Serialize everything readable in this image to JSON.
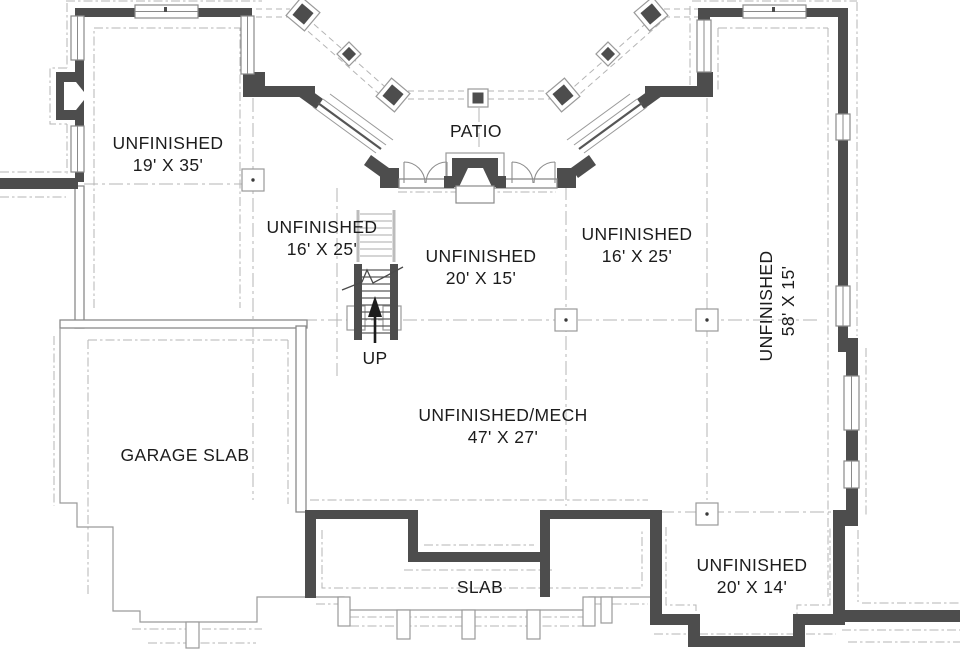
{
  "plan": {
    "title": "basement foundation floor plan",
    "colors": {
      "bg": "#ffffff",
      "wall": "#4d4d4d",
      "thin_wall": "#8a8a8a",
      "footing": "#b5b5b5",
      "text": "#1c1c1c"
    },
    "rooms": {
      "upper_left": {
        "label": "UNFINISHED",
        "dims": "19' X 35'"
      },
      "patio": {
        "label": "PATIO"
      },
      "mid_left": {
        "label": "UNFINISHED",
        "dims": "16' X 25'"
      },
      "center": {
        "label": "UNFINISHED",
        "dims": "20' X 15'"
      },
      "mid_right": {
        "label": "UNFINISHED",
        "dims": "16' X 25'"
      },
      "right_wing": {
        "label": "UNFINISHED",
        "dims": "58' X 15'"
      },
      "garage": {
        "label": "GARAGE SLAB"
      },
      "mech": {
        "label": "UNFINISHED/MECH",
        "dims": "47' X 27'"
      },
      "porch": {
        "label": "SLAB"
      },
      "lower_right": {
        "label": "UNFINISHED",
        "dims": "20' X 14'"
      }
    },
    "stairs": {
      "label": "UP"
    }
  }
}
